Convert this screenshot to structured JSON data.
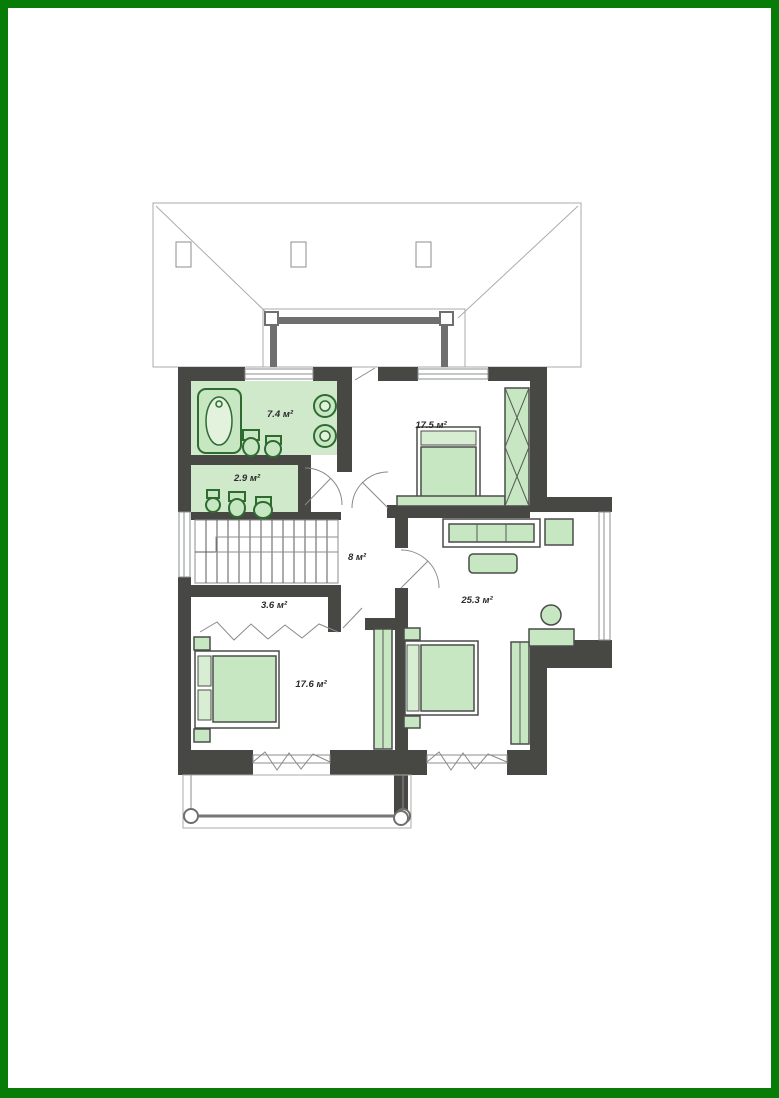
{
  "page": {
    "background": "#ffffff",
    "frame_color": "#077d07",
    "content_type": "architectural floor plan drawing"
  },
  "plan": {
    "type": "floor-plan",
    "rooms": [
      {
        "name": "bathroom",
        "area_label": "7.4 м²"
      },
      {
        "name": "wc",
        "area_label": "2.9 м²"
      },
      {
        "name": "bedroom-top-right",
        "area_label": "17.5 м²"
      },
      {
        "name": "stair-hall",
        "area_label": "8 м²"
      },
      {
        "name": "corridor",
        "area_label": "3.6 м²"
      },
      {
        "name": "living-room",
        "area_label": "25.3 м²"
      },
      {
        "name": "bedroom-bottom-left",
        "area_label": "17.6 м²"
      }
    ],
    "colors": {
      "wall": "#474744",
      "furniture_fill": "#c7e6c2",
      "fixture_stroke": "#2d6b31",
      "floor_tint": "#cfe9ca",
      "roof_line": "#a8adad",
      "label_text": "#2b2b2b",
      "frame": "#077d07"
    }
  }
}
